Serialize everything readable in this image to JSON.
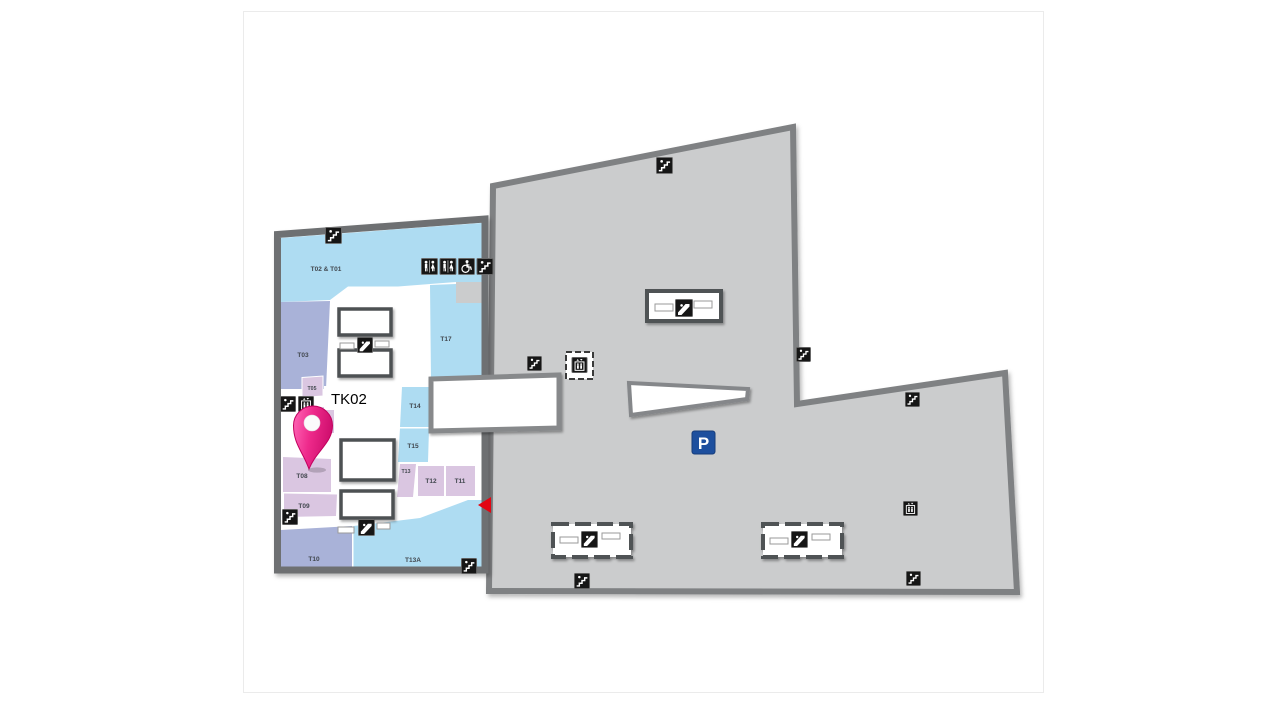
{
  "title": {
    "number": "3",
    "suffix": "F"
  },
  "map": {
    "marker": {
      "label": "TK02"
    },
    "parking_label": "P",
    "tenants": [
      {
        "label": "T02 & T01",
        "zone": "blue"
      },
      {
        "label": "T17",
        "zone": "blue"
      },
      {
        "label": "T03",
        "zone": "periwinkle"
      },
      {
        "label": "T05",
        "zone": "lilac"
      },
      {
        "label": "T06",
        "zone": "lilac"
      },
      {
        "label": "T08",
        "zone": "lilac"
      },
      {
        "label": "T09",
        "zone": "lilac"
      },
      {
        "label": "T10",
        "zone": "periwinkle"
      },
      {
        "label": "T14",
        "zone": "blue"
      },
      {
        "label": "T15",
        "zone": "blue"
      },
      {
        "label": "T13",
        "zone": "lilac"
      },
      {
        "label": "T12",
        "zone": "lilac"
      },
      {
        "label": "T11",
        "zone": "lilac"
      },
      {
        "label": "T13A",
        "zone": "blue"
      }
    ],
    "icons": [
      "stairs-icon",
      "escalator-icon",
      "elevator-icon",
      "restroom-icon",
      "accessible-icon",
      "parking-sign",
      "entrance-arrow"
    ],
    "colors": {
      "building_fill": "#cbcccd",
      "building_border": "#7f8183",
      "wall": "#6e7072",
      "zone_blue": "#aedcf2",
      "zone_periwinkle": "#a9b2d8",
      "zone_lilac": "#dac6e1",
      "icon_bg": "#161616",
      "parking_blue": "#1d4f9e",
      "arrow_red": "#e30613",
      "pin_pink": "#ee2a7b"
    }
  }
}
